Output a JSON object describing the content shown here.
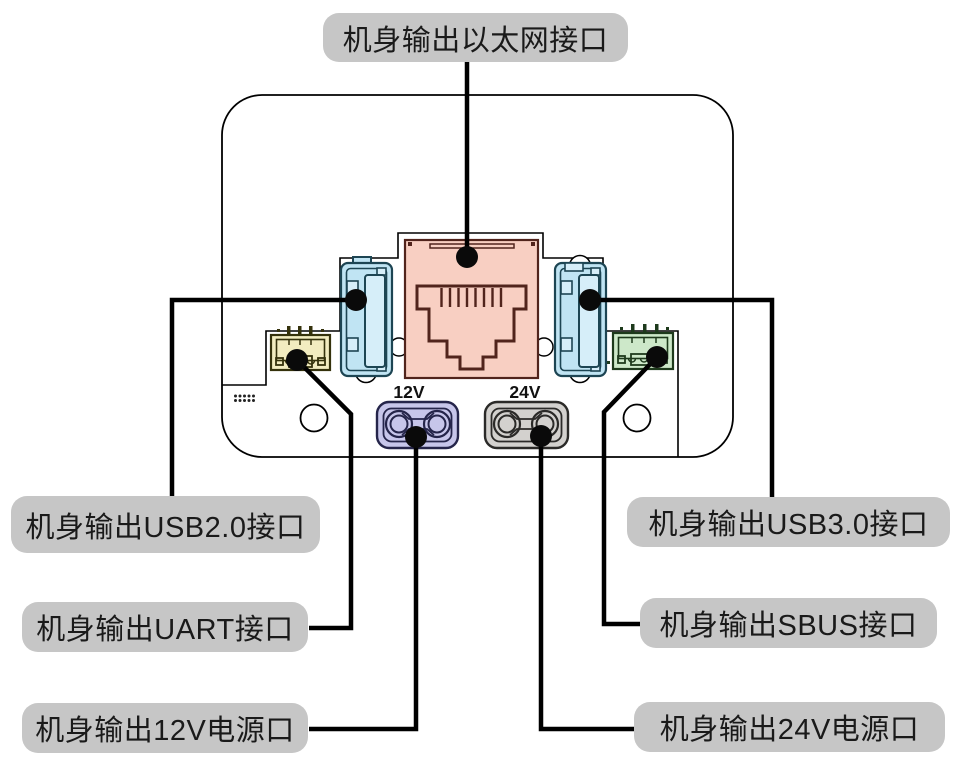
{
  "diagram": {
    "labels": {
      "ethernet": "机身输出以太网接口",
      "usb2": "机身输出USB2.0接口",
      "uart": "机身输出UART接口",
      "power12v": "机身输出12V电源口",
      "usb3": "机身输出USB3.0接口",
      "sbus": "机身输出SBUS接口",
      "power24v": "机身输出24V电源口"
    },
    "port_markings": {
      "v12": "12V",
      "v24": "24V"
    },
    "colors": {
      "label_background": "#c6c6c6",
      "text": "#1a1a1a",
      "line": "#000000",
      "ethernet_fill": "#f8cfc2",
      "ethernet_outline": "#51241c",
      "usb_fill": "#c0e4f3",
      "usb_inner_fill": "#d6eef9",
      "usb_outline": "#1d4553",
      "uart_fill": "#f2ecc0",
      "uart_outline": "#35320c",
      "sbus_fill": "#cde8c9",
      "sbus_outline": "#1e3a1c",
      "power12v_fill": "#c7c6ea",
      "power12v_outline": "#25254a",
      "power24v_fill": "#d3d1ce",
      "power24v_outline": "#2b2a28"
    }
  }
}
